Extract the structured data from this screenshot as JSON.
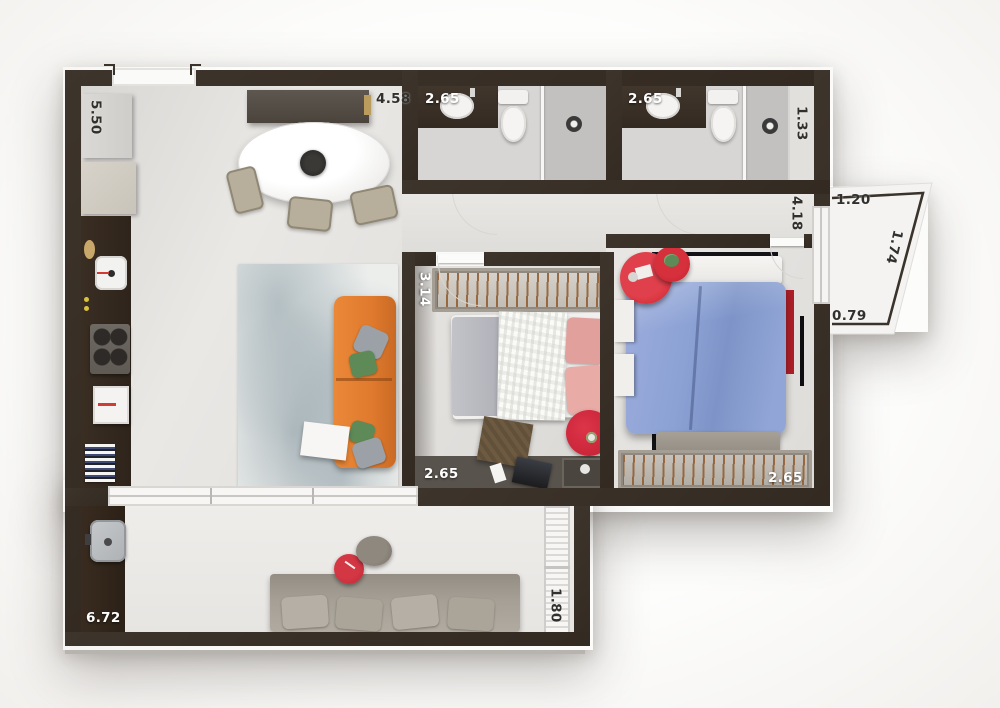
{
  "plan_title": "apartment-3d-floor-plan",
  "dimension_labels": {
    "kitchen_side": "5.50",
    "living_top": "4.58",
    "bathroom_1_width": "2.65",
    "bathroom_2_width": "2.65",
    "shaft_side": "1.33",
    "balcony_top": "1.20",
    "balcony_diagonal": "1.74",
    "corridor_side": "4.18",
    "balcony_bottom": "0.79",
    "bedroom_1_side": "3.14",
    "bedroom_1_width": "2.65",
    "bedroom_2_width": "2.65",
    "terrace_width": "6.72",
    "terrace_side": "1.80"
  },
  "colors": {
    "wall_dark": "#362d25",
    "floor_light": "#e6e4e1",
    "terrace_floor": "#ebe9e6",
    "counter_dark": "#342a21",
    "sofa_orange": "#e07a2e",
    "duvet_blue": "#8ea4d4",
    "pillow_pink": "#e5a5a0",
    "accent_red": "#ce2330",
    "outdoor_sofa_gray": "#a6a096",
    "rug_blue_gray": "#c3ccd0",
    "label_white": "#ffffff",
    "label_dark": "#32302d"
  }
}
